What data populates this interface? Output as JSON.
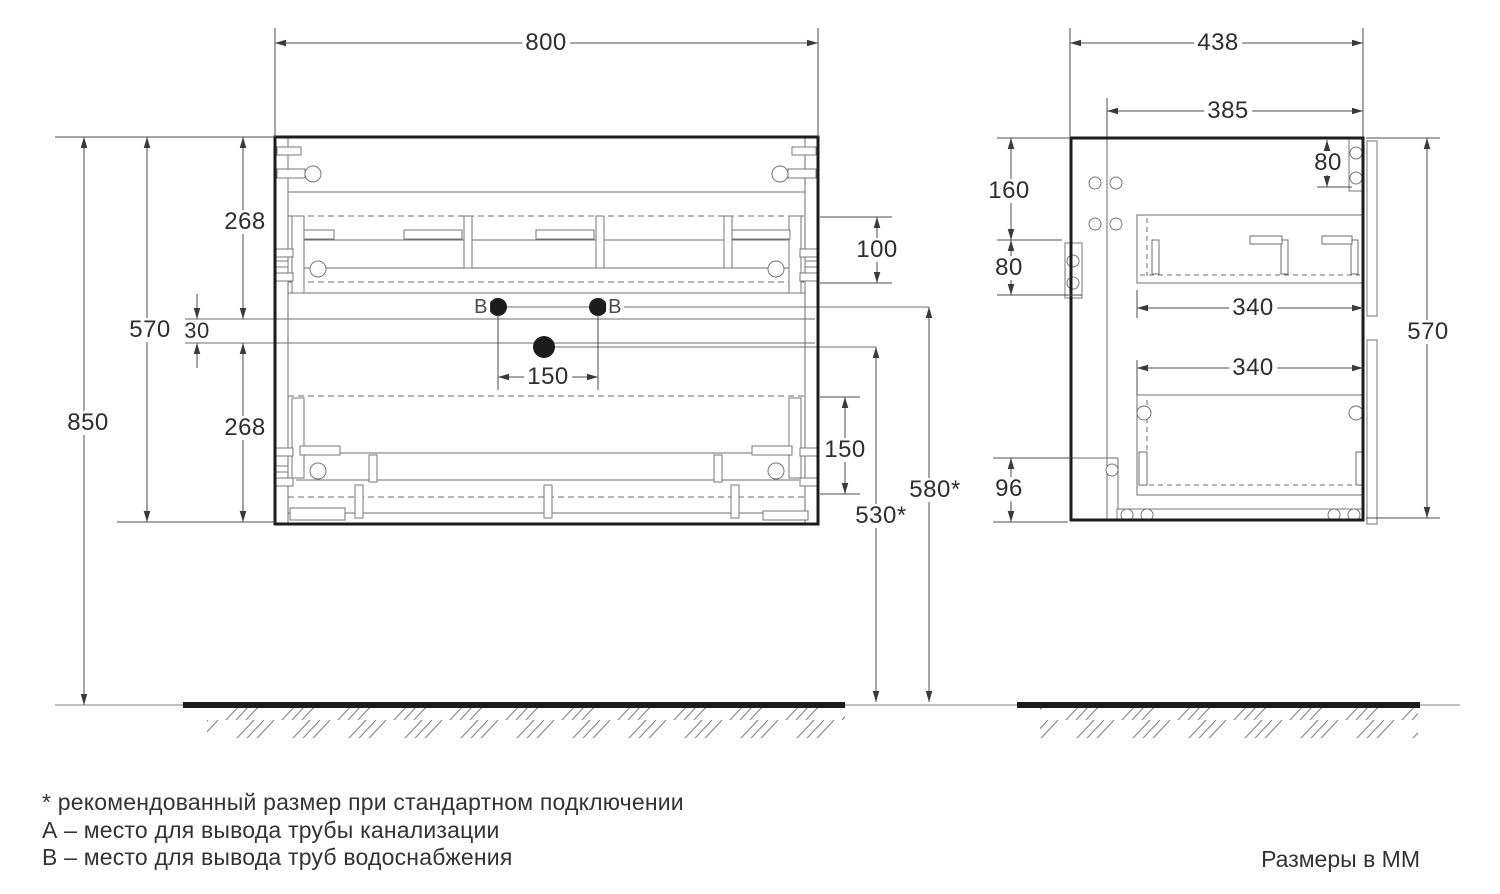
{
  "front_view": {
    "width": "800",
    "upper_drawer_height": "268",
    "cabinet_height": "570",
    "gap": "30",
    "mount_height": "850",
    "lower_drawer_height": "268",
    "supply_spacing": "150",
    "upper_drawer_inner": "100",
    "lower_drawer_inner": "150",
    "water_supply_height": "580*",
    "drain_height": "530*",
    "point_b_left": "В",
    "point_b_right": "В"
  },
  "side_view": {
    "depth": "438",
    "inner_depth": "385",
    "hanger_height": "80",
    "top_offset": "160",
    "bracket_height": "80",
    "upper_drawer_depth": "340",
    "lower_drawer_depth": "340",
    "cabinet_height": "570",
    "bottom_offset": "96"
  },
  "footer": {
    "note_asterisk": "* рекомендованный размер при стандартном подключении",
    "note_a": "А – место для вывода трубы канализации",
    "note_b": "В – место для вывода труб водоснабжения",
    "units": "Размеры в ММ"
  },
  "colors": {
    "outline": "#1c1c1c",
    "thin_line": "#6e6e6e",
    "dim_line": "#4d4d4d",
    "text": "#2e2e2e"
  }
}
